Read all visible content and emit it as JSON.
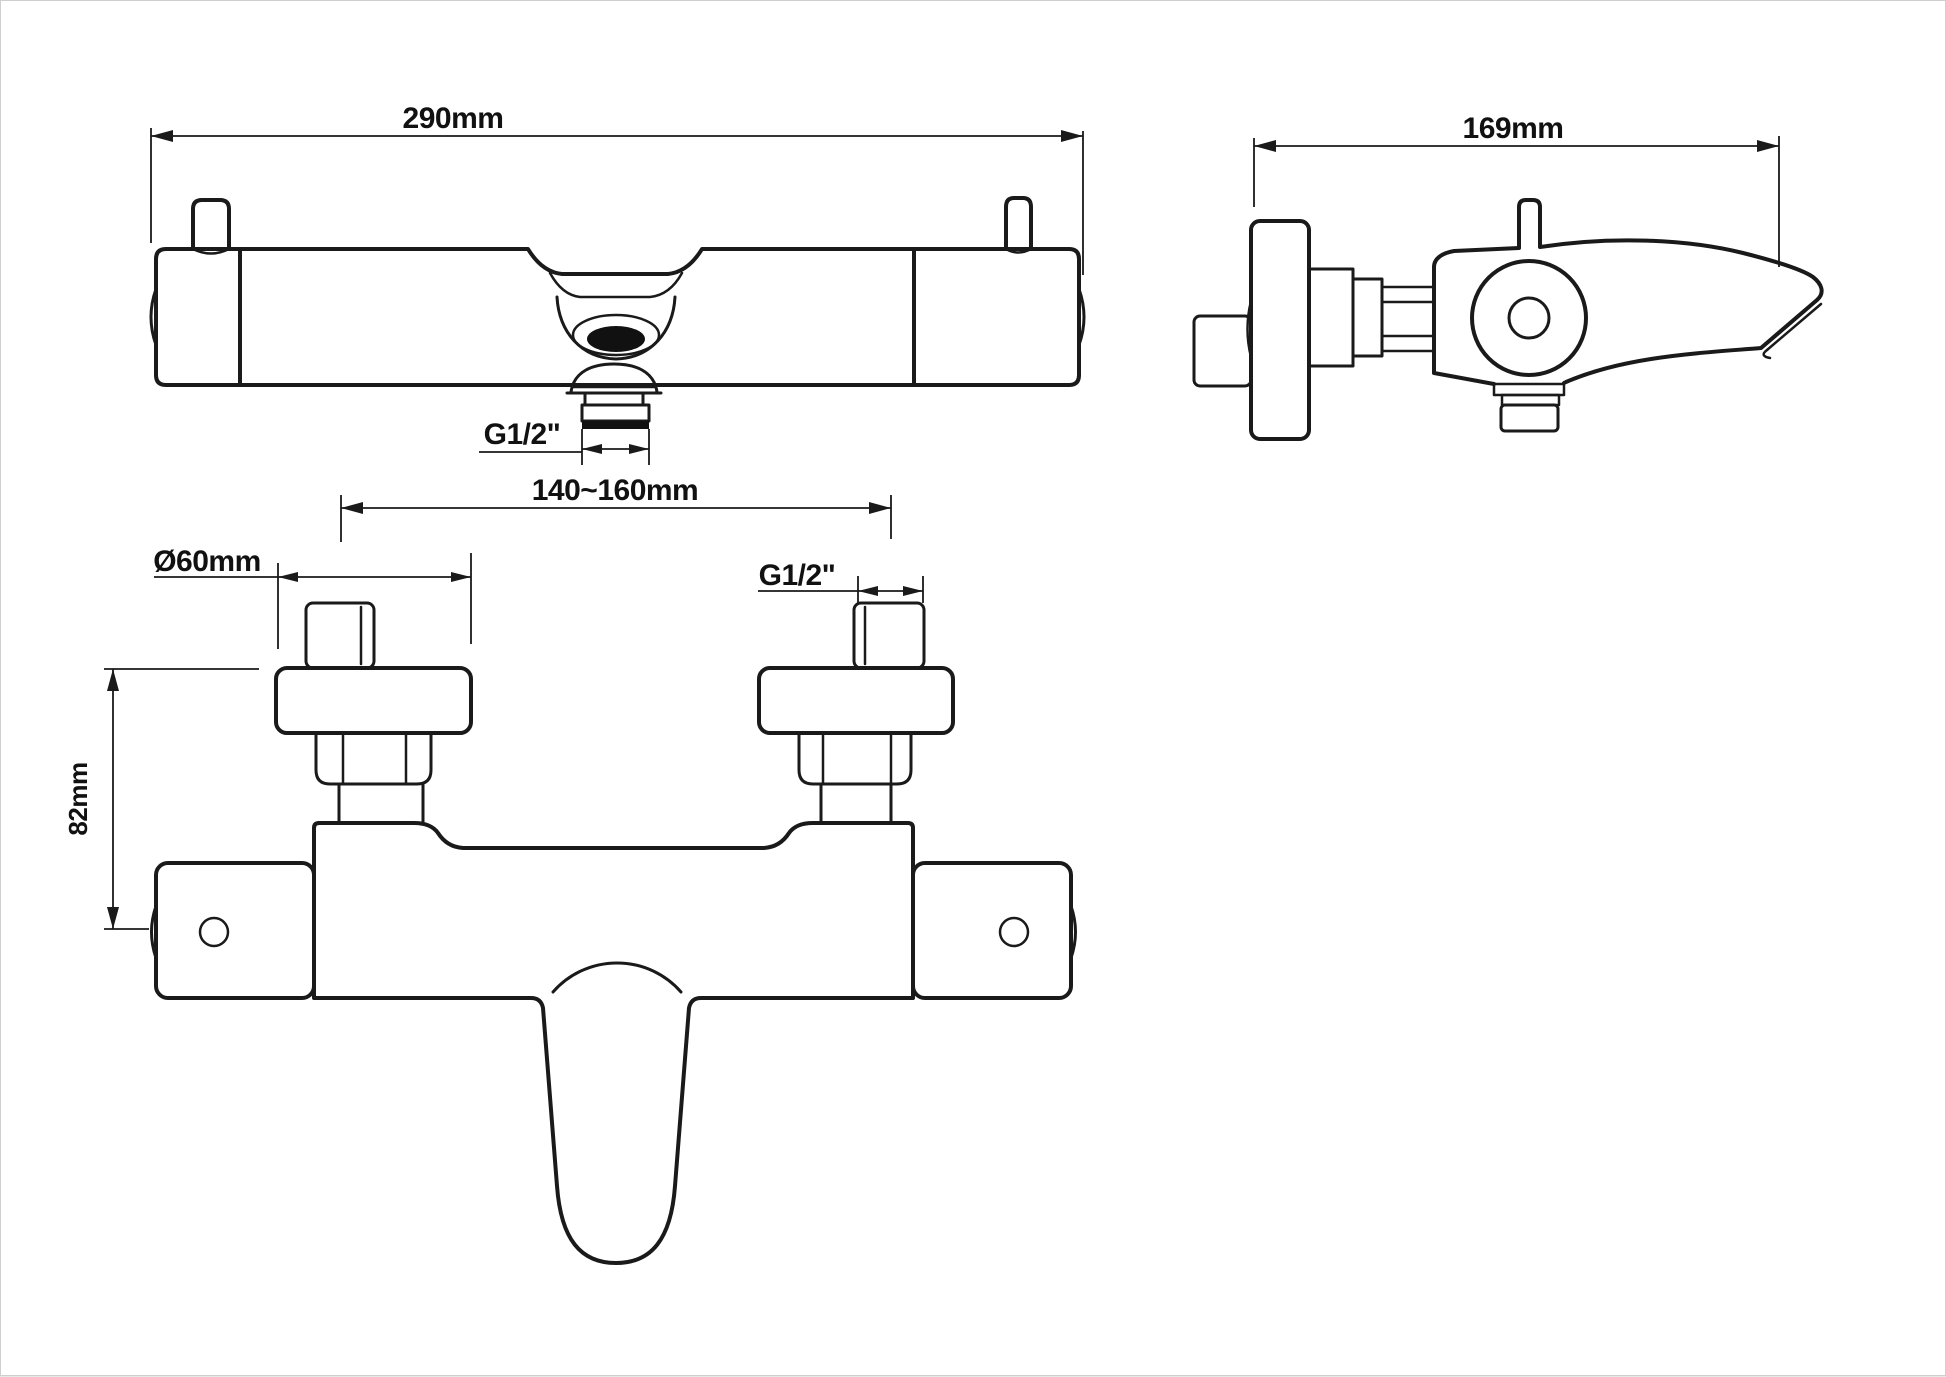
{
  "page": {
    "background_color": "#ffffff",
    "line_color": "#1a1a1a"
  },
  "drawing": {
    "type": "technical-drawing",
    "subject": "wall-mounted thermostatic bath shower mixer tap, three orthographic views",
    "views": {
      "top_view": {
        "name": "top view (plan)",
        "dimensions": {
          "overall_width": "290mm",
          "outlet_thread": "G1/2\""
        }
      },
      "front_view": {
        "name": "front view",
        "dimensions": {
          "wall_fitting_spacing": "140~160mm",
          "escutcheon_diameter": "Ø60mm",
          "body_height": "82mm",
          "inlet_thread": "G1/2\""
        }
      },
      "side_view": {
        "name": "side view",
        "dimensions": {
          "overall_depth": "169mm"
        }
      }
    }
  }
}
